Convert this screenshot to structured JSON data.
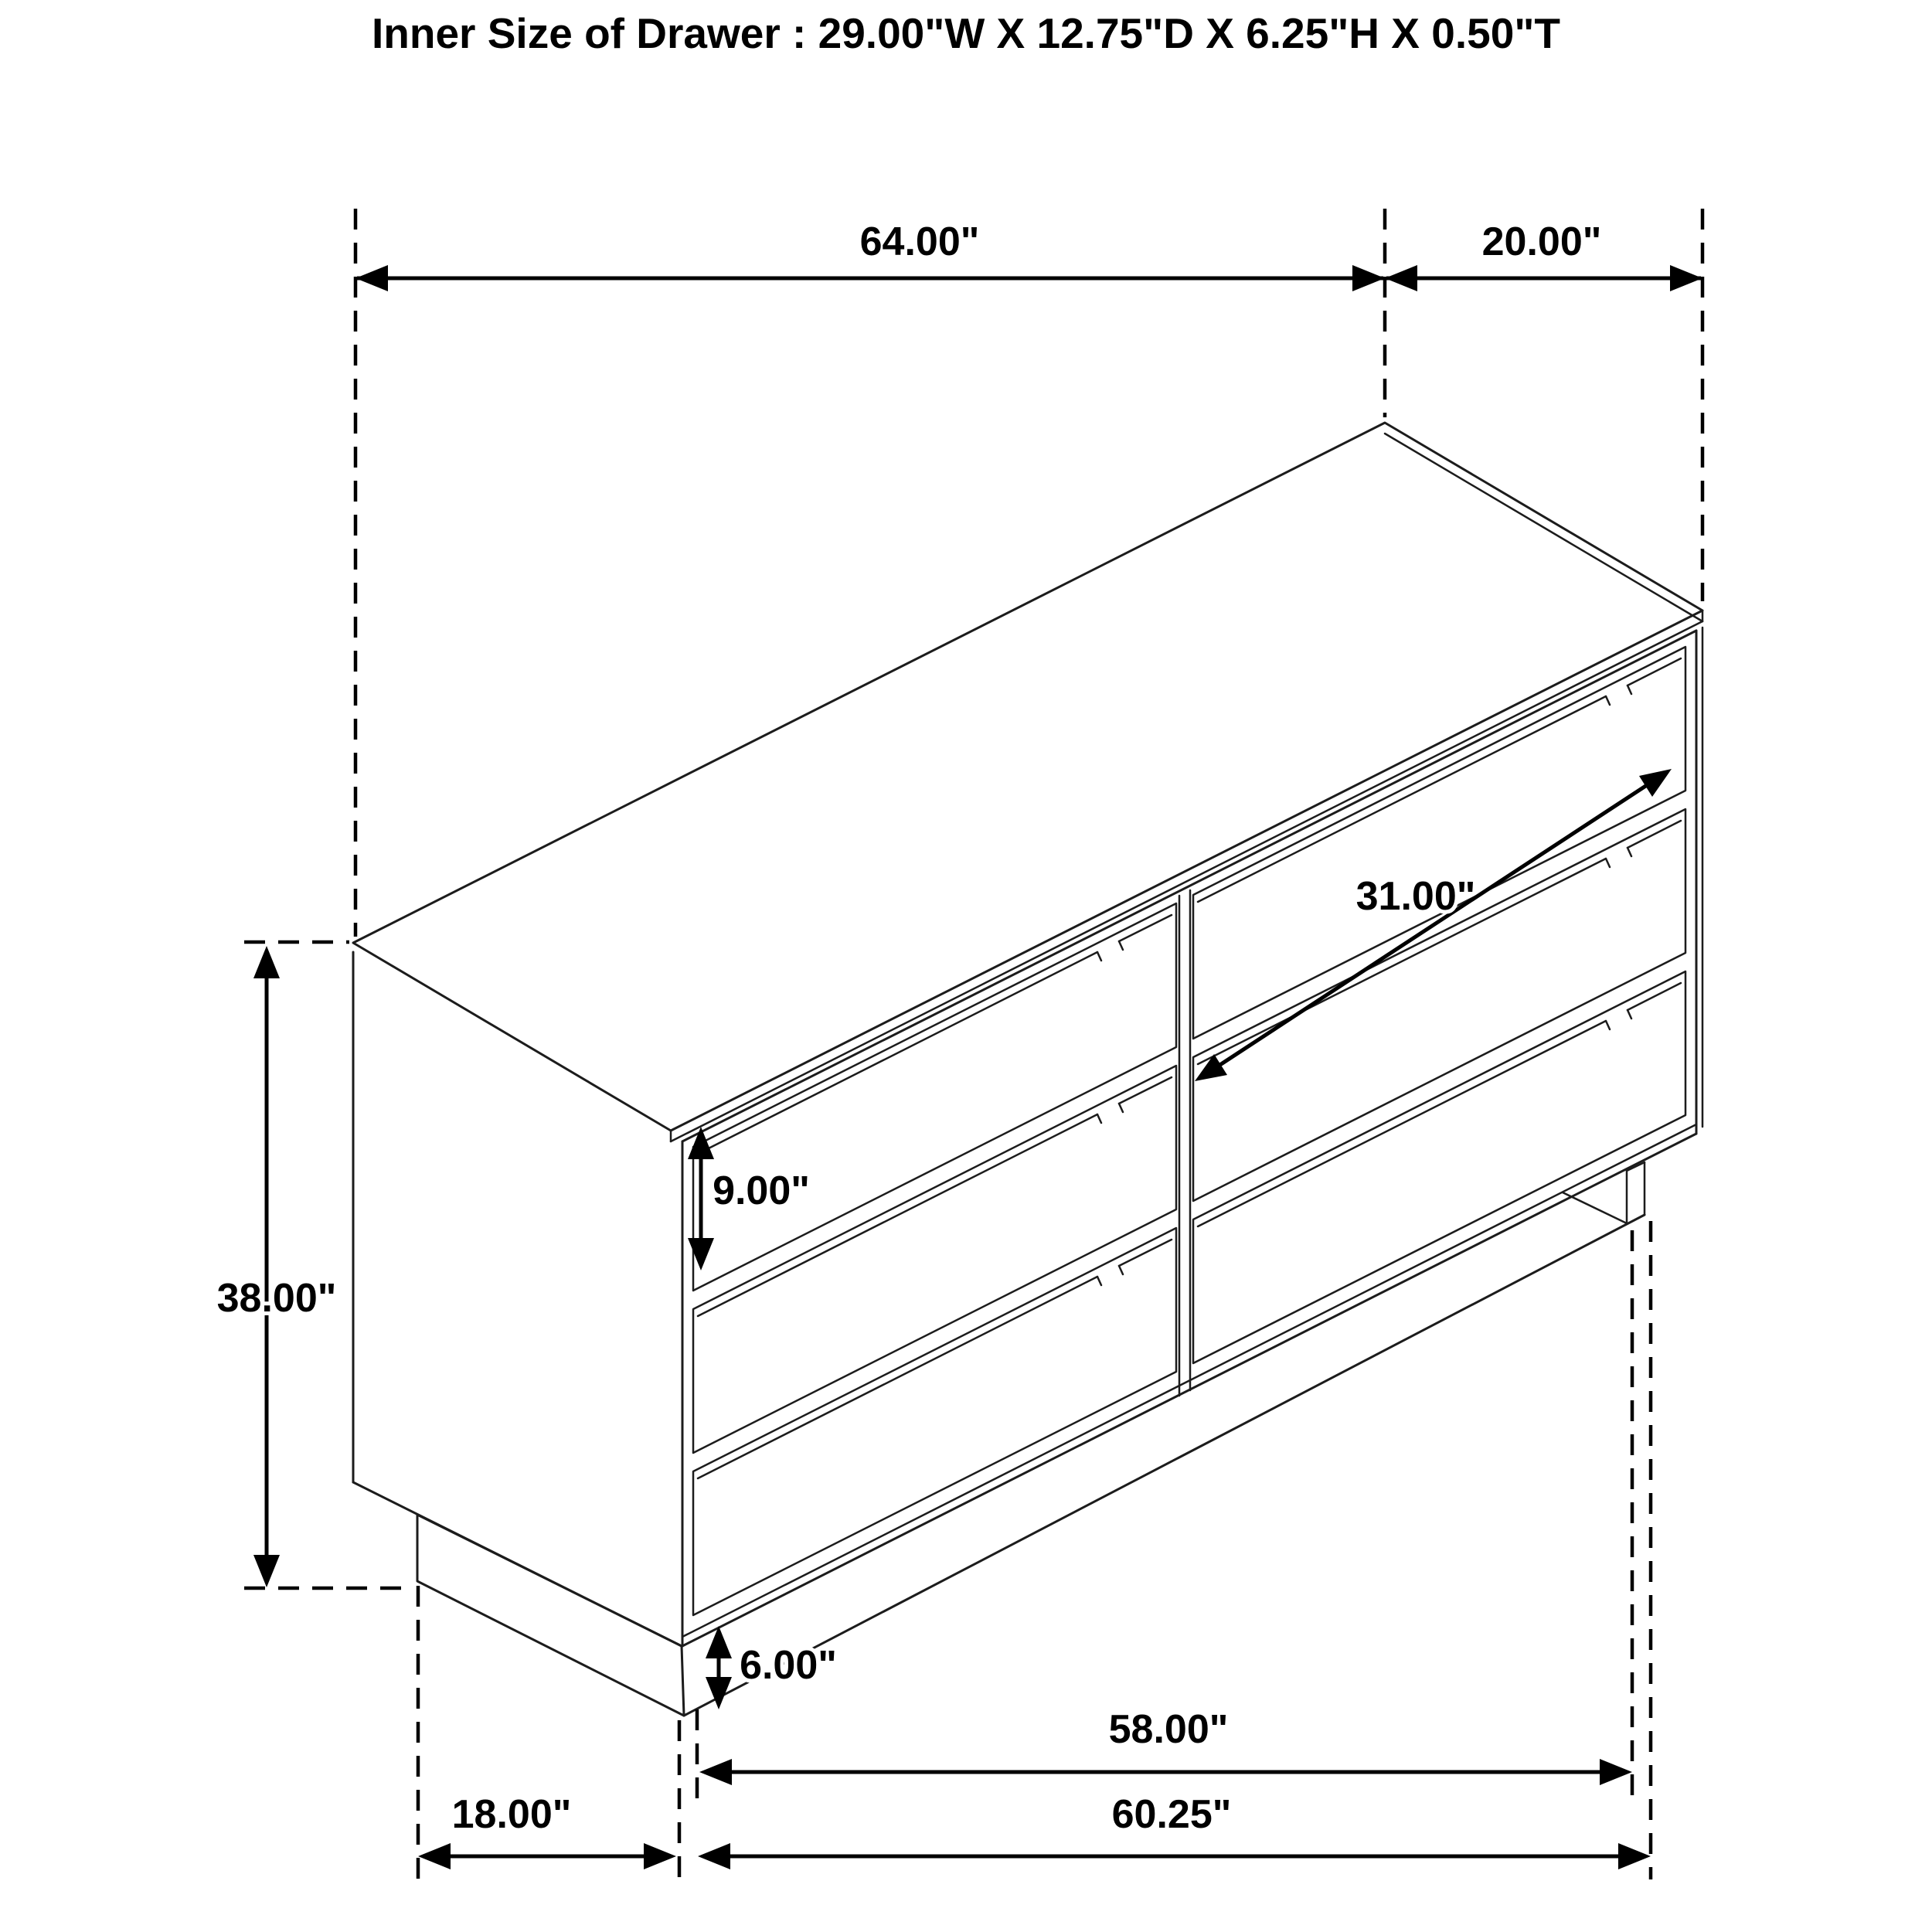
{
  "title": {
    "text": "Inner Size of Drawer : 29.00\"W X 12.75\"D X 6.25\"H X 0.50\"T"
  },
  "dimensions": {
    "top_width": "64.00\"",
    "top_depth": "20.00\"",
    "drawer_opening_width": "31.00\"",
    "drawer_front_height": "9.00\"",
    "overall_height": "38.00\"",
    "base_height": "6.00\"",
    "base_inner_width": "58.00\"",
    "base_side_depth": "18.00\"",
    "base_outer_width": "60.25\""
  }
}
